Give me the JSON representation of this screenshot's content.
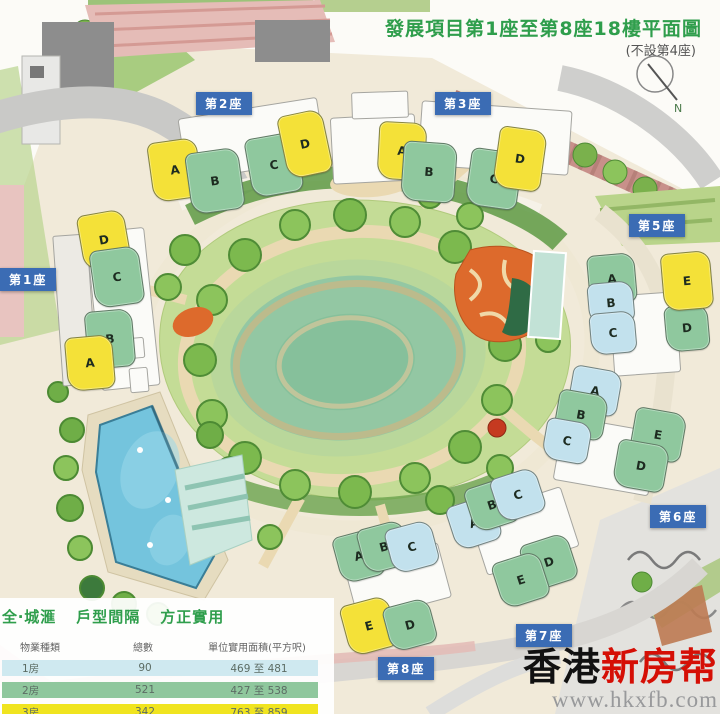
{
  "title": {
    "main": "發展項目第1座至第8座18樓平面圖",
    "sub": "(不設第4座)"
  },
  "compass": {
    "north_label": "N"
  },
  "unit_type_colors": {
    "1br": "#c2e1ed",
    "2br": "#8fc89e",
    "3br": "#f4e138"
  },
  "map": {
    "towers": [
      {
        "id": "1",
        "badge": "第1座",
        "badge_pos": {
          "x": 0,
          "y": 268
        },
        "units": [
          {
            "label": "D",
            "type": "3br",
            "x": 80,
            "y": 212,
            "w": 46,
            "h": 54,
            "rot": -10
          },
          {
            "label": "C",
            "type": "2br",
            "x": 92,
            "y": 248,
            "w": 48,
            "h": 56,
            "rot": -8
          },
          {
            "label": "B",
            "type": "2br",
            "x": 86,
            "y": 310,
            "w": 46,
            "h": 56,
            "rot": -5
          },
          {
            "label": "A",
            "type": "3br",
            "x": 66,
            "y": 336,
            "w": 46,
            "h": 52,
            "rot": -5
          }
        ]
      },
      {
        "id": "2",
        "badge": "第2座",
        "badge_pos": {
          "x": 196,
          "y": 92
        },
        "units": [
          {
            "label": "A",
            "type": "3br",
            "x": 150,
            "y": 140,
            "w": 48,
            "h": 58,
            "rot": -8
          },
          {
            "label": "B",
            "type": "2br",
            "x": 188,
            "y": 150,
            "w": 52,
            "h": 60,
            "rot": -8
          },
          {
            "label": "C",
            "type": "2br",
            "x": 248,
            "y": 135,
            "w": 50,
            "h": 58,
            "rot": -10
          },
          {
            "label": "D",
            "type": "3br",
            "x": 282,
            "y": 112,
            "w": 44,
            "h": 62,
            "rot": -12
          }
        ]
      },
      {
        "id": "3",
        "badge": "第3座",
        "badge_pos": {
          "x": 435,
          "y": 92
        },
        "units": [
          {
            "label": "A",
            "type": "3br",
            "x": 378,
            "y": 122,
            "w": 46,
            "h": 56,
            "rot": 3
          },
          {
            "label": "B",
            "type": "2br",
            "x": 402,
            "y": 142,
            "w": 52,
            "h": 58,
            "rot": 4
          },
          {
            "label": "C",
            "type": "2br",
            "x": 468,
            "y": 150,
            "w": 50,
            "h": 56,
            "rot": 8
          },
          {
            "label": "D",
            "type": "3br",
            "x": 496,
            "y": 128,
            "w": 46,
            "h": 60,
            "rot": 8
          }
        ]
      },
      {
        "id": "5",
        "badge": "第5座",
        "badge_pos": {
          "x": 629,
          "y": 214
        },
        "units": [
          {
            "label": "A",
            "type": "2br",
            "x": 588,
            "y": 254,
            "w": 46,
            "h": 48,
            "rot": -5
          },
          {
            "label": "B",
            "type": "1br",
            "x": 588,
            "y": 282,
            "w": 44,
            "h": 40,
            "rot": -5
          },
          {
            "label": "C",
            "type": "1br",
            "x": 590,
            "y": 312,
            "w": 44,
            "h": 40,
            "rot": -5
          },
          {
            "label": "D",
            "type": "2br",
            "x": 665,
            "y": 305,
            "w": 42,
            "h": 44,
            "rot": -5
          },
          {
            "label": "E",
            "type": "3br",
            "x": 662,
            "y": 252,
            "w": 48,
            "h": 56,
            "rot": -5
          }
        ]
      },
      {
        "id": "6",
        "badge": "第6座",
        "badge_pos": {
          "x": 650,
          "y": 505
        },
        "units": [
          {
            "label": "A",
            "type": "1br",
            "x": 570,
            "y": 368,
            "w": 48,
            "h": 44,
            "rot": 10
          },
          {
            "label": "B",
            "type": "2br",
            "x": 556,
            "y": 392,
            "w": 48,
            "h": 44,
            "rot": 10
          },
          {
            "label": "C",
            "type": "1br",
            "x": 544,
            "y": 420,
            "w": 44,
            "h": 40,
            "rot": 10
          },
          {
            "label": "E",
            "type": "2br",
            "x": 632,
            "y": 410,
            "w": 50,
            "h": 48,
            "rot": 10
          },
          {
            "label": "D",
            "type": "2br",
            "x": 615,
            "y": 442,
            "w": 50,
            "h": 46,
            "rot": 10
          }
        ]
      },
      {
        "id": "7",
        "badge": "第7座",
        "badge_pos": {
          "x": 516,
          "y": 624
        },
        "units": [
          {
            "label": "A",
            "type": "1br",
            "x": 450,
            "y": 500,
            "w": 46,
            "h": 44,
            "rot": -18
          },
          {
            "label": "B",
            "type": "2br",
            "x": 468,
            "y": 482,
            "w": 46,
            "h": 44,
            "rot": -18
          },
          {
            "label": "C",
            "type": "1br",
            "x": 494,
            "y": 472,
            "w": 46,
            "h": 44,
            "rot": -18
          },
          {
            "label": "D",
            "type": "2br",
            "x": 524,
            "y": 538,
            "w": 48,
            "h": 46,
            "rot": -18
          },
          {
            "label": "E",
            "type": "2br",
            "x": 496,
            "y": 556,
            "w": 48,
            "h": 46,
            "rot": -18
          }
        ]
      },
      {
        "id": "8",
        "badge": "第8座",
        "badge_pos": {
          "x": 378,
          "y": 657
        },
        "units": [
          {
            "label": "A",
            "type": "2br",
            "x": 336,
            "y": 532,
            "w": 44,
            "h": 46,
            "rot": -15
          },
          {
            "label": "B",
            "type": "2br",
            "x": 360,
            "y": 524,
            "w": 46,
            "h": 44,
            "rot": -15
          },
          {
            "label": "C",
            "type": "1br",
            "x": 388,
            "y": 524,
            "w": 46,
            "h": 44,
            "rot": -15
          },
          {
            "label": "E",
            "type": "3br",
            "x": 344,
            "y": 600,
            "w": 48,
            "h": 50,
            "rot": -15
          },
          {
            "label": "D",
            "type": "2br",
            "x": 386,
            "y": 602,
            "w": 46,
            "h": 44,
            "rot": -15
          }
        ]
      }
    ]
  },
  "info": {
    "heading_parts": [
      "全‧城滙",
      "戶型間隔",
      "方正實用"
    ],
    "table": {
      "columns": [
        "物業種類",
        "總數",
        "單位實用面積(平方呎)"
      ],
      "rows": [
        {
          "type": "1房",
          "count": "90",
          "area": "469 至 481",
          "color": "#cfe9f0"
        },
        {
          "type": "2房",
          "count": "521",
          "area": "427 至 538",
          "color": "#8fc79d"
        },
        {
          "type": "3房",
          "count": "342",
          "area": "763 至 859",
          "color": "#f0e41f"
        }
      ]
    }
  },
  "watermark": {
    "brand_black": "香港",
    "brand_red": "新房帮",
    "url": "www.hkxfb.com"
  }
}
